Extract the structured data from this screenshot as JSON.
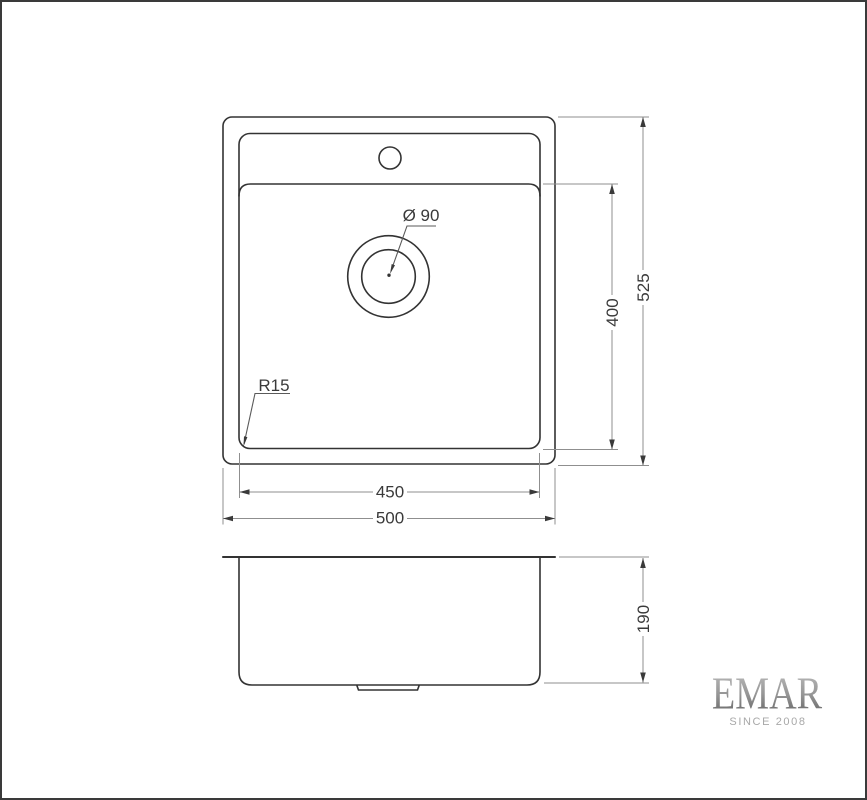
{
  "drawing": {
    "kind": "sink-dimension-drawing",
    "dims": {
      "outer_width": "500",
      "inner_width": "450",
      "outer_length": "525",
      "bowl_length": "400",
      "height": "190",
      "drain_diameter": "Ø 90",
      "corner_radius": "R15"
    },
    "brand": {
      "name": "EMAR",
      "tagline": "SINCE 2008"
    },
    "colors": {
      "background": "#ffffff",
      "page_border": "#3a3a3a",
      "object_line": "#333333",
      "dimension_line": "#8f8f8f",
      "dimension_text": "#3a3a3a",
      "logo_gradient_top": "#bfbfbf",
      "logo_gradient_mid": "#979797",
      "logo_gradient_bottom": "#5c5c5c",
      "tagline_text": "#a8a8a8"
    }
  }
}
